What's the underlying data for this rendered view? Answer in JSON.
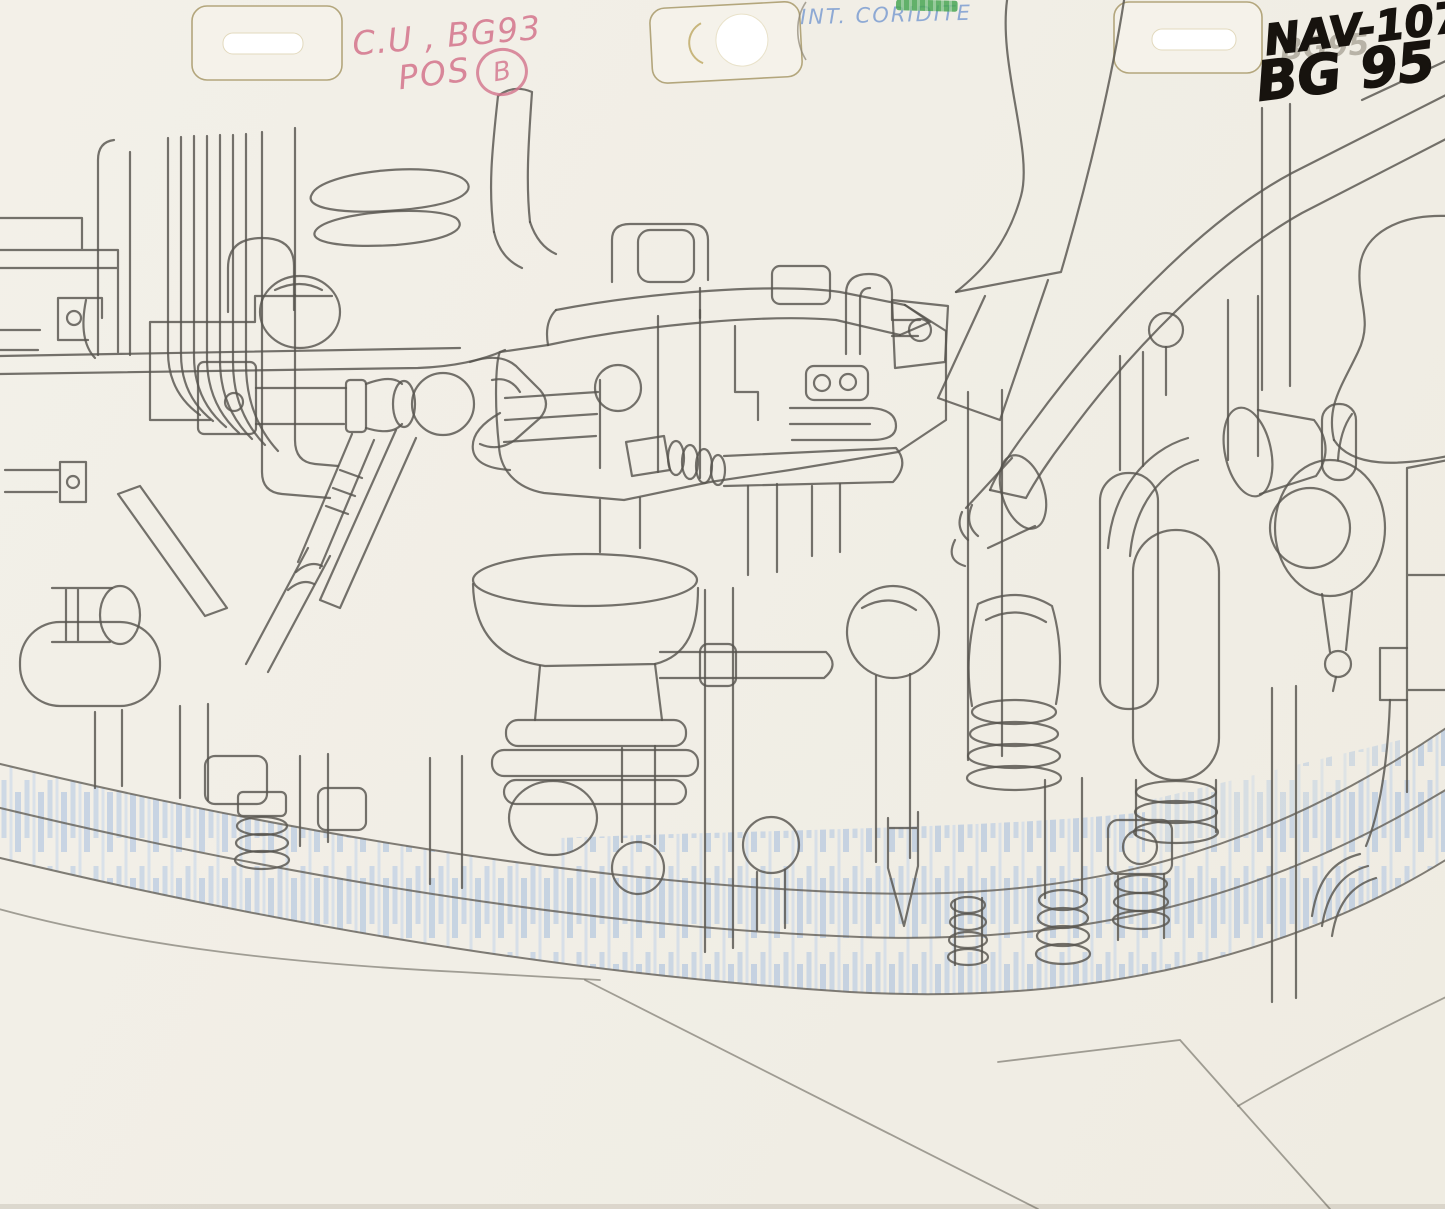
{
  "sheet": {
    "kind_label": "animation background pencil drawing of dense machinery",
    "paper_color": "#f2efe7",
    "line_color": "#57544e",
    "shading_color": "#a9c2e3"
  },
  "peg_strip": {
    "patch_count": "3",
    "outline_color": "#b3a67c"
  },
  "annotations": {
    "red_pencil": {
      "line1": "C.U , BG93",
      "line2": "POS",
      "circled_letter": "B",
      "color": "#d4748c"
    },
    "blue_pencil": {
      "scene_label": "INT. CORIDITE",
      "color": "#7d9ed2"
    },
    "pencil_ghost": {
      "text": "BG95"
    },
    "black_marker": {
      "line1": "NAV-107",
      "line2": "BG 95",
      "color": "#17130e"
    },
    "green_crayon": {
      "color": "#49a654"
    }
  }
}
